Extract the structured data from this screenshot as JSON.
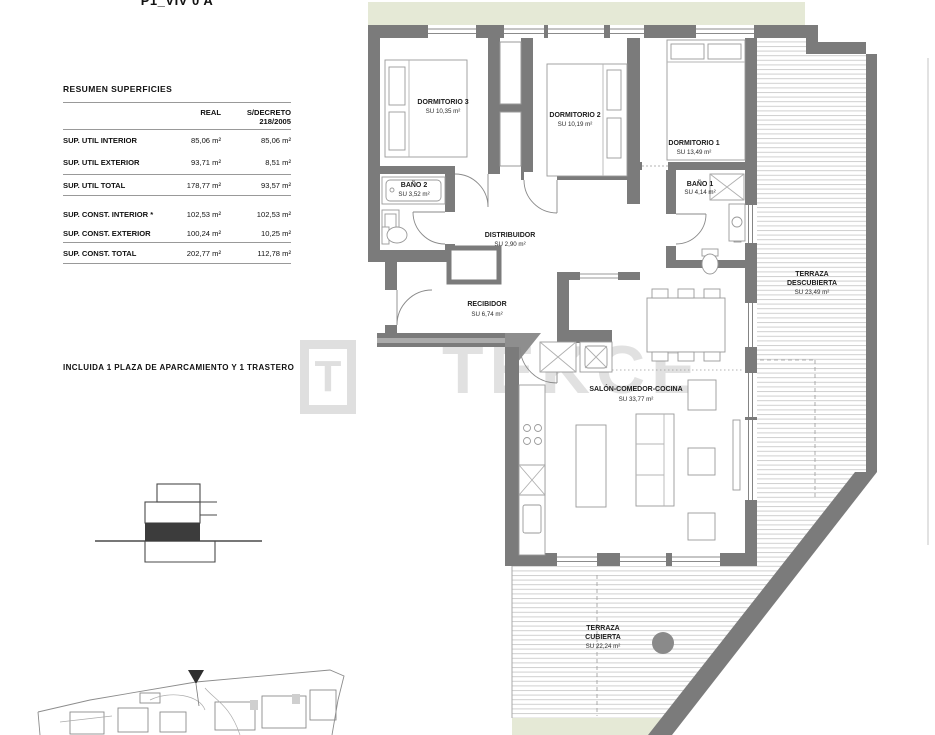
{
  "title": "P1_VIV 0 A",
  "summary": {
    "heading": "RESUMEN SUPERFICIES",
    "columns": {
      "real": "REAL",
      "decreto_l1": "S/DECRETO",
      "decreto_l2": "218/2005"
    },
    "rows": [
      {
        "label": "SUP. UTIL INTERIOR",
        "real": "85,06 m²",
        "decreto": "85,06 m²"
      },
      {
        "label": "SUP. UTIL EXTERIOR",
        "real": "93,71 m²",
        "decreto": "8,51 m²"
      },
      {
        "label": "SUP. UTIL TOTAL",
        "real": "178,77 m²",
        "decreto": "93,57 m²"
      },
      {
        "label": "SUP. CONST. INTERIOR *",
        "real": "102,53 m²",
        "decreto": "102,53 m²"
      },
      {
        "label": "SUP. CONST. EXTERIOR",
        "real": "100,24 m²",
        "decreto": "10,25 m²"
      },
      {
        "label": "SUP. CONST. TOTAL",
        "real": "202,77 m²",
        "decreto": "112,78 m²"
      }
    ]
  },
  "note": "INCLUIDA 1 PLAZA DE APARCAMIENTO Y 1 TRASTERO",
  "watermark": {
    "logo_letter": "T",
    "text": "TEKCE"
  },
  "rooms": {
    "dormitorio3": {
      "name": "DORMITORIO 3",
      "area": "SU 10,35 m²"
    },
    "dormitorio2": {
      "name": "DORMITORIO 2",
      "area": "SU 10,19 m²"
    },
    "dormitorio1": {
      "name": "DORMITORIO 1",
      "area": "SU 13,49 m²"
    },
    "bano2": {
      "name": "BAÑO 2",
      "area": "SU 3,52 m²"
    },
    "bano1": {
      "name": "BAÑO 1",
      "area": "SU 4,14 m²"
    },
    "distribuidor": {
      "name": "DISTRIBUIDOR",
      "area": "SU 2,90 m²"
    },
    "recibidor": {
      "name": "RECIBIDOR",
      "area": "SU 6,74 m²"
    },
    "salon": {
      "name": "SALÓN-COMEDOR-COCINA",
      "area": "SU 33,77 m²"
    },
    "terraza_descubierta": {
      "name_l1": "TERRAZA",
      "name_l2": "DESCUBIERTA",
      "area": "SU 23,49 m²"
    },
    "terraza_cubierta": {
      "name_l1": "TERRAZA",
      "name_l2": "CUBIERTA",
      "area": "SU 22,24 m²"
    }
  },
  "colors": {
    "wall": "#7b7b7b",
    "green_strip": "#e5e9d6",
    "deck_line": "#cfcfcf",
    "highlight_floor": "#3c3c3c"
  }
}
